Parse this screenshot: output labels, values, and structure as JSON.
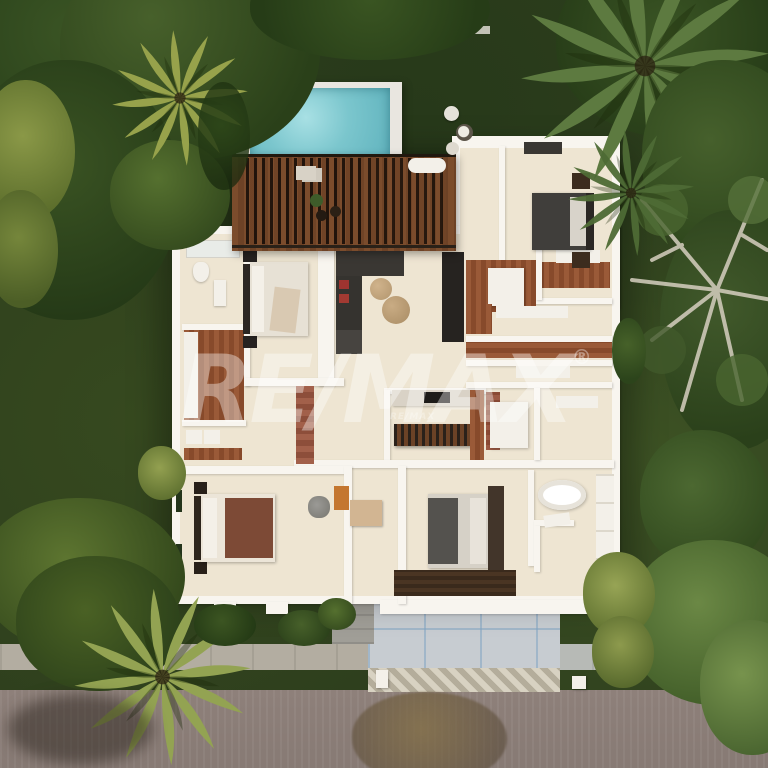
{
  "image": {
    "type": "aerial-3d-floor-plan-render",
    "description": "Top-down 3D architectural render of a villa: bedrooms, living room, kitchen, bathrooms, rooftop pool with wooden pergola deck, tropical garden, paver driveway and street"
  },
  "watermark": {
    "text": "RE/MAX",
    "registered": "®",
    "small_text": "RE/MAX"
  },
  "palette": {
    "grass": "#2e3f1d",
    "foliage_dark": "#24371a",
    "foliage_mid": "#3f582a",
    "foliage_light": "#6d8440",
    "palm_yellow": "#97a24b",
    "pool_water": "#76c4cc",
    "deck_wood": "#7b4c2c",
    "pergola_slat": "#2c2015",
    "wall_white": "#f8f5ef",
    "floor_cream": "#eee5d2",
    "wood_floor": "#9a5a38",
    "road": "#8a7c76",
    "sidewalk": "#b3ada1",
    "driveway_paver": "#c7ccd1",
    "accent_red_pillow": "#9e3430",
    "bed_dark": "#403e3b",
    "bed_brown": "#7d4a36",
    "orange_mat": "#c4762f"
  }
}
